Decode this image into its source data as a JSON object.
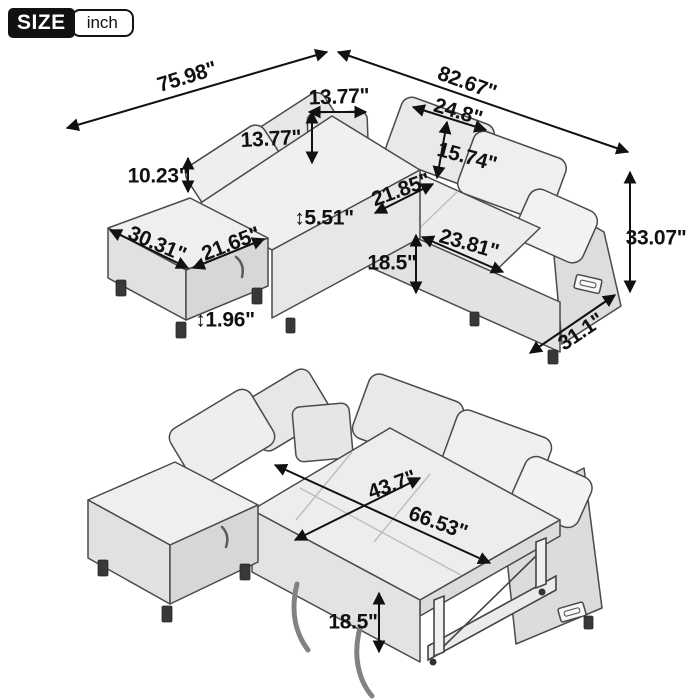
{
  "badge": {
    "size_label": "SIZE",
    "unit_label": "inch"
  },
  "colors": {
    "ink": "#111111",
    "outline": "#4a4a4a",
    "fabric_light": "#efefef",
    "fabric_mid": "#e2e2e2",
    "fabric_dark": "#d7d7d7",
    "leg": "#383838"
  },
  "top_view": {
    "description": "sectional-sofa-with-ottoman-dimensions",
    "dims": [
      {
        "id": "width-left",
        "text": "75.98\""
      },
      {
        "id": "width-right",
        "text": "82.67\""
      },
      {
        "id": "corner-pillow-width",
        "text": "13.77\""
      },
      {
        "id": "corner-pillow-height",
        "text": "13.77\""
      },
      {
        "id": "back-cushion-width",
        "text": "24.8\""
      },
      {
        "id": "back-cushion-height",
        "text": "15.74\""
      },
      {
        "id": "backrest-above-seat",
        "text": "10.23\""
      },
      {
        "id": "seat-depth",
        "text": "21.85\""
      },
      {
        "id": "seat-cushion-thickness",
        "text": "↕5.51\""
      },
      {
        "id": "ottoman-width",
        "text": "30.31\""
      },
      {
        "id": "ottoman-depth",
        "text": "21.65\""
      },
      {
        "id": "seat-width",
        "text": "23.81\""
      },
      {
        "id": "seat-height",
        "text": "18.5\""
      },
      {
        "id": "overall-height",
        "text": "33.07\""
      },
      {
        "id": "arm-depth",
        "text": "31.1\""
      },
      {
        "id": "leg-height",
        "text": "↕1.96\""
      }
    ]
  },
  "bottom_view": {
    "description": "sofa-converted-to-sleeper-bed-dimensions",
    "dims": [
      {
        "id": "bed-width",
        "text": "43.7\""
      },
      {
        "id": "bed-length",
        "text": "66.53\""
      },
      {
        "id": "bed-height",
        "text": "18.5\""
      }
    ]
  }
}
